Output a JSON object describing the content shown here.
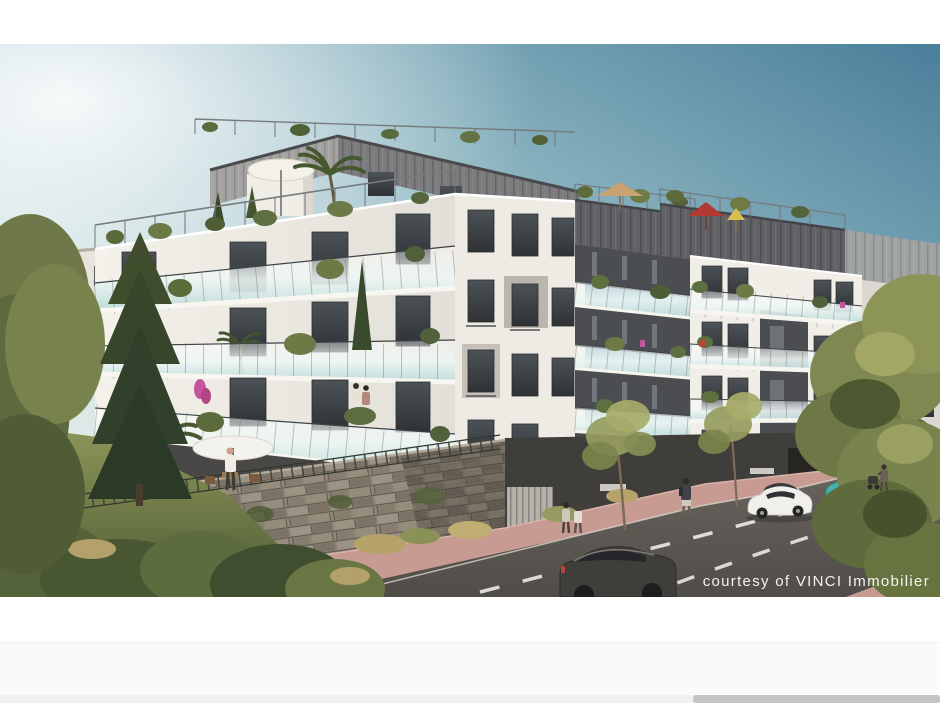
{
  "photo_credit": {
    "text": "courtesy of VINCI Immobilier",
    "color": "#ffffff"
  },
  "scene": {
    "type": "architectural-rendering",
    "subject": "Modern white residential apartment complex with glass balconies, zinc-clad rooftop floors, rooftop terraces with parasols, stone retaining wall, landscaped garden, street with parked cars, pedestrians and trees",
    "colors": {
      "sky_teal": "#4a7f9a",
      "sky_glow": "#eef2ee",
      "facade_white": "#f4f1eb",
      "zinc_roof_light": "#a3a2a0",
      "zinc_roof_dark": "#6a6a6e",
      "window_glass": "#3a3f44",
      "balcony_glass": "#cfe6e3",
      "stone_wall": "#958c7e",
      "road_asphalt": "#5c5852",
      "bike_lane_pink": "#c79b92",
      "grass_green": "#7e8952",
      "foliage_olive": "#7e8850",
      "car_white": "#f1efeb",
      "car_teal": "#3fb5ae",
      "suv_dark": "#403e3a",
      "umbrella_red": "#b23a30",
      "umbrella_tan": "#c9a173",
      "curtain_teal": "#5fc7b5"
    },
    "objects": [
      "apartment-building-left-wing",
      "apartment-building-center-tower",
      "apartment-building-middle-wing",
      "apartment-building-right-wing",
      "rooftop-terrace-umbrellas",
      "stone-retaining-wall",
      "garden-with-fence",
      "street-road",
      "pink-bike-lane",
      "white-hatchback",
      "teal-city-car",
      "dark-suv",
      "pedestrians",
      "street-trees",
      "large-right-tree"
    ]
  },
  "scrollbar": {
    "track_color": "#f1f0ee",
    "thumb_color": "#c6c4c2"
  }
}
